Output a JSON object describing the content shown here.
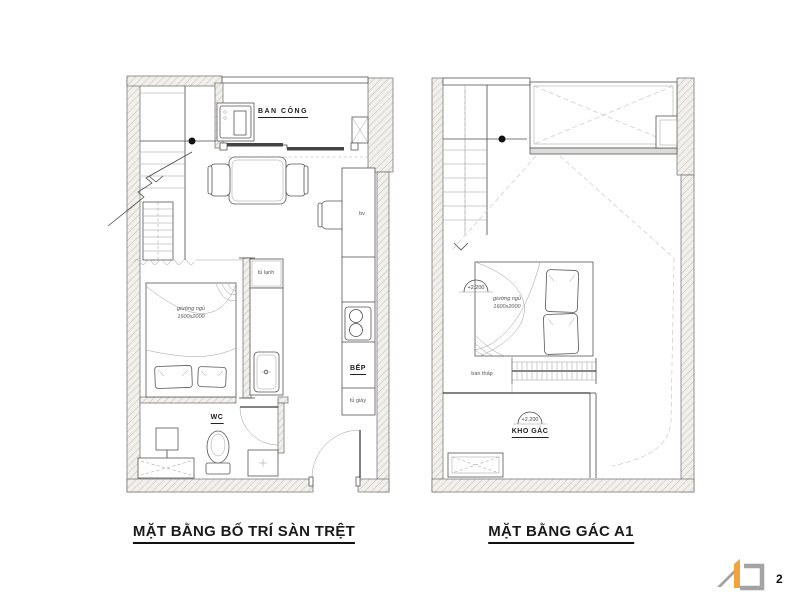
{
  "sheet": {
    "page_number": "2"
  },
  "ground_plan": {
    "title": "MẶT BẰNG BỐ TRÍ SÀN TRỆT",
    "labels": {
      "balcony": "BAN CÔNG",
      "desk": "bv",
      "fridge": "tủ lạnh",
      "bed_line1": "giường ngủ",
      "bed_line2": "1600x2000",
      "kitchen": "BẾP",
      "shoe_cabinet": "tủ giày",
      "wc": "WC"
    }
  },
  "mezzanine_plan": {
    "title": "MẶT BẰNG GÁC A1",
    "labels": {
      "bed_level": "+2.200",
      "bed_line1": "giường ngủ",
      "bed_line2": "1600x2000",
      "low_table": "bàn thấp",
      "storage_level": "+2.200",
      "storage": "KHO GÁC"
    }
  },
  "colors": {
    "line": "#4a4a4a",
    "wall_fill": "#f1f0ec",
    "wall_hatch": "#bdbbb3",
    "accent_orange": "#f2a33c",
    "logo_gray": "#a3a3a3",
    "text": "#1a1a1a"
  }
}
